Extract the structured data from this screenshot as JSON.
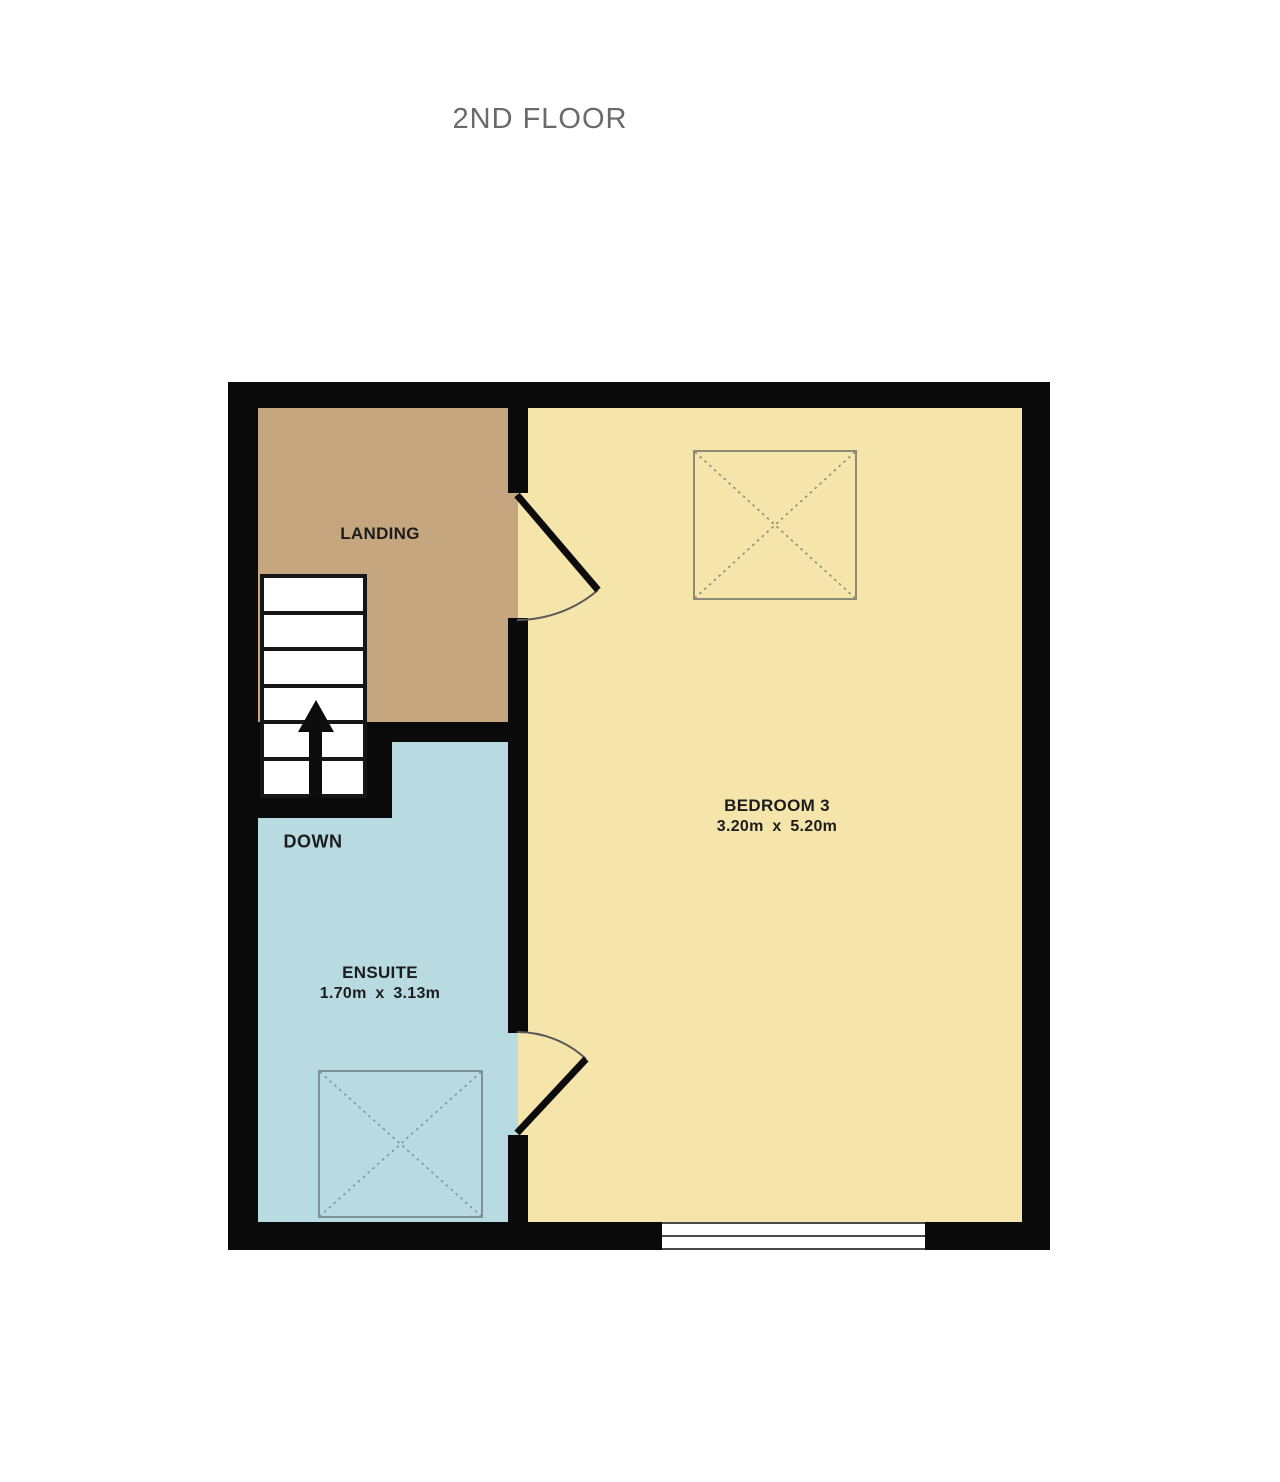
{
  "title": "2ND FLOOR",
  "plan": {
    "landing": {
      "label": "LANDING"
    },
    "bedroom": {
      "label": "BEDROOM 3",
      "dims": "3.20m x 5.20m"
    },
    "ensuite": {
      "label": "ENSUITE",
      "dims": "1.70m x 3.13m"
    },
    "stairs": {
      "label": "DOWN",
      "steps": 6,
      "direction": "up"
    }
  },
  "colors": {
    "landing": "#c5a67e",
    "bedroom": "#f5e5ab",
    "ensuite": "#b8dbe2",
    "wall": "#0a0a0a",
    "title_text": "#6a6a6a",
    "label_text": "#1c1c1c",
    "marker_bedroom": "#8b8a74",
    "marker_ensuite": "#7e9399",
    "door_leaf": "#0c0c0c",
    "door_arc": "#5a5a5a"
  }
}
